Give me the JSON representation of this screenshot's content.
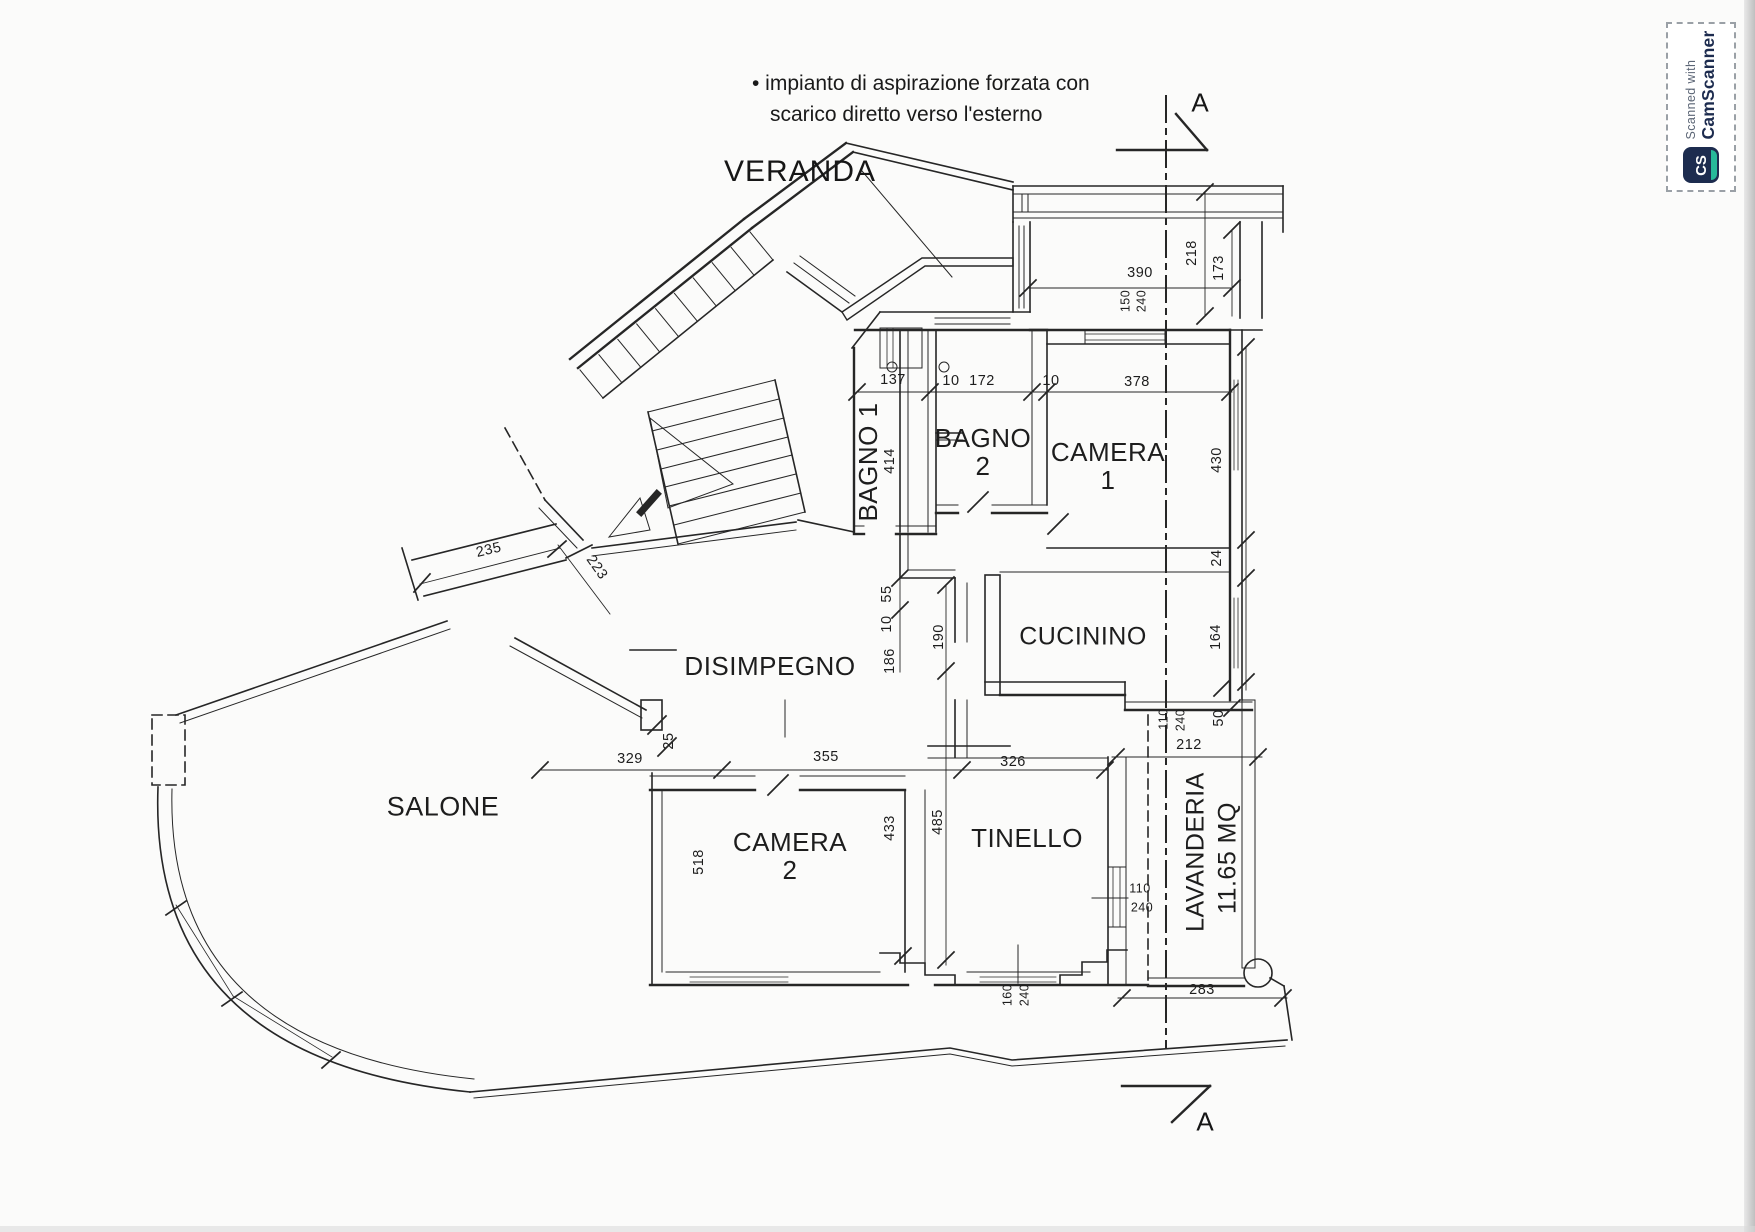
{
  "annotation": {
    "line1": "• impianto di aspirazione forzata con",
    "line2": "scarico diretto verso l'esterno"
  },
  "veranda": {
    "label": "VERANDA"
  },
  "section": {
    "marker_top": "A",
    "marker_bottom": "A"
  },
  "rooms": [
    {
      "id": "bagno-1",
      "label": "BAGNO 1",
      "x": 868,
      "y": 462,
      "rot": -90,
      "size": 26
    },
    {
      "id": "bagno-2",
      "label": "BAGNO\n2",
      "x": 983,
      "y": 452,
      "rot": 0,
      "size": 26
    },
    {
      "id": "camera-1",
      "label": "CAMERA\n1",
      "x": 1108,
      "y": 466,
      "rot": 0,
      "size": 26
    },
    {
      "id": "cucinino",
      "label": "CUCININO",
      "x": 1083,
      "y": 637,
      "rot": 0,
      "size": 25
    },
    {
      "id": "disimpegno",
      "label": "DISIMPEGNO",
      "x": 770,
      "y": 666,
      "rot": 0,
      "size": 26
    },
    {
      "id": "salone",
      "label": "SALONE",
      "x": 443,
      "y": 807,
      "rot": 0,
      "size": 27
    },
    {
      "id": "camera-2",
      "label": "CAMERA\n2",
      "x": 790,
      "y": 856,
      "rot": 0,
      "size": 26
    },
    {
      "id": "tinello",
      "label": "TINELLO",
      "x": 1027,
      "y": 838,
      "rot": 0,
      "size": 26
    },
    {
      "id": "lavanderia",
      "label": "LAVANDERIA",
      "x": 1196,
      "y": 852,
      "rot": -90,
      "size": 25
    },
    {
      "id": "lavanderia-area",
      "label": "11.65 MQ",
      "x": 1228,
      "y": 858,
      "rot": -90,
      "size": 25
    }
  ],
  "dimensions": [
    {
      "text": "390",
      "x": 1140,
      "y": 274,
      "rot": 0
    },
    {
      "text": "150",
      "x": 1126,
      "y": 301,
      "rot": -90,
      "s": 12.5
    },
    {
      "text": "240",
      "x": 1142,
      "y": 301,
      "rot": -90,
      "s": 12.5
    },
    {
      "text": "218",
      "x": 1193,
      "y": 253,
      "rot": -90
    },
    {
      "text": "173",
      "x": 1220,
      "y": 268,
      "rot": -90
    },
    {
      "text": "137",
      "x": 893,
      "y": 381,
      "rot": 0
    },
    {
      "text": "10",
      "x": 951,
      "y": 382,
      "rot": 0
    },
    {
      "text": "172",
      "x": 982,
      "y": 382,
      "rot": 0
    },
    {
      "text": "10",
      "x": 1051,
      "y": 382,
      "rot": 0
    },
    {
      "text": "378",
      "x": 1137,
      "y": 383,
      "rot": 0
    },
    {
      "text": "414",
      "x": 891,
      "y": 461,
      "rot": -90
    },
    {
      "text": "430",
      "x": 1218,
      "y": 460,
      "rot": -90
    },
    {
      "text": "24",
      "x": 1218,
      "y": 558,
      "rot": -90
    },
    {
      "text": "55",
      "x": 888,
      "y": 594,
      "rot": -90
    },
    {
      "text": "10",
      "x": 888,
      "y": 624,
      "rot": -90
    },
    {
      "text": "190",
      "x": 940,
      "y": 637,
      "rot": -90
    },
    {
      "text": "186",
      "x": 891,
      "y": 661,
      "rot": -90
    },
    {
      "text": "164",
      "x": 1217,
      "y": 637,
      "rot": -90
    },
    {
      "text": "110",
      "x": 1164,
      "y": 719,
      "rot": -90,
      "s": 12.5
    },
    {
      "text": "240",
      "x": 1181,
      "y": 720,
      "rot": -90,
      "s": 12.5
    },
    {
      "text": "50",
      "x": 1220,
      "y": 718,
      "rot": -90
    },
    {
      "text": "212",
      "x": 1189,
      "y": 746,
      "rot": 0
    },
    {
      "text": "326",
      "x": 1013,
      "y": 763,
      "rot": 0
    },
    {
      "text": "329",
      "x": 630,
      "y": 760,
      "rot": 0
    },
    {
      "text": "355",
      "x": 826,
      "y": 758,
      "rot": 0
    },
    {
      "text": "25",
      "x": 670,
      "y": 741,
      "rot": -90
    },
    {
      "text": "235",
      "x": 489,
      "y": 551,
      "rot": -13
    },
    {
      "text": "223",
      "x": 596,
      "y": 568,
      "rot": 55
    },
    {
      "text": "518",
      "x": 700,
      "y": 862,
      "rot": -90
    },
    {
      "text": "433",
      "x": 891,
      "y": 828,
      "rot": -90
    },
    {
      "text": "485",
      "x": 939,
      "y": 822,
      "rot": -90
    },
    {
      "text": "110",
      "x": 1140,
      "y": 889,
      "rot": 0,
      "s": 12.5
    },
    {
      "text": "240",
      "x": 1142,
      "y": 908,
      "rot": 0,
      "s": 12.5
    },
    {
      "text": "160",
      "x": 1008,
      "y": 995,
      "rot": -90,
      "s": 12.5
    },
    {
      "text": "240",
      "x": 1025,
      "y": 995,
      "rot": -90,
      "s": 12.5
    },
    {
      "text": "283",
      "x": 1202,
      "y": 991,
      "rot": 0
    }
  ],
  "camscanner": {
    "scanned_with": "Scanned with",
    "brand": "CamScanner",
    "icon_text": "CS"
  },
  "colors": {
    "ink": "#262626",
    "paper": "#fbfbfa",
    "brand_navy": "#1d2c4f",
    "brand_teal": "#27b99a"
  }
}
